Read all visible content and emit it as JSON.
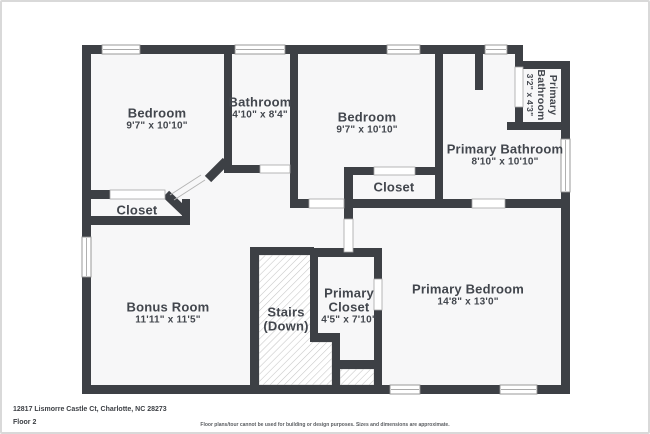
{
  "footer": {
    "address": "12817 Lismorre Castle Ct, Charlotte, NC 28273",
    "floor_label": "Floor 2",
    "disclaimer": "Floor plans/tour cannot be used for building or design purposes. Sizes and dimensions are approximate."
  },
  "colors": {
    "wall": "#3d4045",
    "floor": "#f7f7f8",
    "label": "#42464d",
    "window_stroke": "#8e8e8e",
    "door_stroke": "#a6a6a6",
    "hatch_line": "#c6c6c6",
    "hatch_border": "#c9c9c9",
    "frame_border": "#d9d9d9"
  },
  "floorplan": {
    "floor_outline": "84,47 517,47 517,63 564,63 564,388 84,388",
    "stairs": [
      "257,253 310,253 310,340 330,340 330,383 257,383",
      "338,367 372,367 372,383 338,383"
    ],
    "walls": [
      {
        "x": 80,
        "y": 43,
        "w": 441,
        "h": 9,
        "n": "wall-outer-top"
      },
      {
        "x": 80,
        "y": 43,
        "w": 9,
        "h": 349,
        "n": "wall-outer-left"
      },
      {
        "x": 80,
        "y": 383,
        "w": 488,
        "h": 9,
        "n": "wall-outer-bottom"
      },
      {
        "x": 559,
        "y": 59,
        "w": 9,
        "h": 333,
        "n": "wall-outer-right"
      },
      {
        "x": 513,
        "y": 59,
        "w": 55,
        "h": 8,
        "n": "wall-primary-bath-small-top"
      },
      {
        "x": 513,
        "y": 43,
        "w": 8,
        "h": 24,
        "n": "wall-primary-bath-small-left-upper"
      },
      {
        "x": 513,
        "y": 105,
        "w": 8,
        "h": 23,
        "n": "wall-primary-bath-small-left-lower"
      },
      {
        "x": 505,
        "y": 120,
        "w": 63,
        "h": 8,
        "n": "wall-primary-bath-small-bottom"
      },
      {
        "x": 222,
        "y": 43,
        "w": 8,
        "h": 120,
        "n": "wall-bedroom1-bathroom"
      },
      {
        "x": 288,
        "y": 43,
        "w": 8,
        "h": 162,
        "n": "wall-bathroom-bedroom2"
      },
      {
        "x": 222,
        "y": 163,
        "w": 36,
        "h": 8,
        "n": "wall-bathroom-bottom"
      },
      {
        "x": 80,
        "y": 188,
        "w": 28,
        "h": 9,
        "n": "wall-bedroom1-bottom"
      },
      {
        "x": 80,
        "y": 214,
        "w": 108,
        "h": 9,
        "n": "wall-closet1-bottom"
      },
      {
        "x": 180,
        "y": 197,
        "w": 8,
        "h": 26,
        "n": "wall-closet1-right"
      },
      {
        "x": 288,
        "y": 197,
        "w": 19,
        "h": 9,
        "n": "wall-bedroom2-bottom"
      },
      {
        "x": 342,
        "y": 197,
        "w": 128,
        "h": 9,
        "n": "wall-mid-horizontal-left"
      },
      {
        "x": 503,
        "y": 197,
        "w": 57,
        "h": 9,
        "n": "wall-mid-horizontal-right"
      },
      {
        "x": 342,
        "y": 165,
        "w": 9,
        "h": 52,
        "n": "wall-closet2-left"
      },
      {
        "x": 342,
        "y": 165,
        "w": 30,
        "h": 8,
        "n": "wall-closet2-top-left"
      },
      {
        "x": 413,
        "y": 165,
        "w": 28,
        "h": 8,
        "n": "wall-closet2-top-right"
      },
      {
        "x": 433,
        "y": 43,
        "w": 8,
        "h": 163,
        "n": "wall-bedroom2-right"
      },
      {
        "x": 473,
        "y": 52,
        "w": 8,
        "h": 36,
        "n": "wall-primary-bath-niche"
      },
      {
        "x": 248,
        "y": 245,
        "w": 9,
        "h": 147,
        "n": "wall-stairs-left"
      },
      {
        "x": 248,
        "y": 245,
        "w": 64,
        "h": 8,
        "n": "wall-stairs-top"
      },
      {
        "x": 308,
        "y": 246,
        "w": 72,
        "h": 9,
        "n": "wall-primary-closet-top"
      },
      {
        "x": 308,
        "y": 246,
        "w": 8,
        "h": 90,
        "n": "wall-primary-closet-left"
      },
      {
        "x": 308,
        "y": 331,
        "w": 30,
        "h": 9,
        "n": "wall-primary-closet-step-h"
      },
      {
        "x": 330,
        "y": 331,
        "w": 8,
        "h": 52,
        "n": "wall-primary-closet-step-v"
      },
      {
        "x": 330,
        "y": 358,
        "w": 48,
        "h": 9,
        "n": "wall-primary-closet-lower-h"
      },
      {
        "x": 372,
        "y": 246,
        "w": 8,
        "h": 31,
        "n": "wall-primary-closet-right-upper"
      },
      {
        "x": 372,
        "y": 308,
        "w": 8,
        "h": 84,
        "n": "wall-primary-closet-right-lower"
      }
    ],
    "diagonal_walls": [
      {
        "x1": 224,
        "y1": 159,
        "x2": 206,
        "y2": 177,
        "w": 9
      },
      {
        "x1": 164,
        "y1": 192,
        "x2": 185,
        "y2": 212,
        "w": 9
      }
    ],
    "door_arcs": [
      {
        "x1": 203,
        "y1": 178,
        "x2": 172,
        "y2": 198
      },
      {
        "x1": 199,
        "y1": 173,
        "x2": 168,
        "y2": 193
      }
    ],
    "doors": [
      {
        "x": 108,
        "y": 188,
        "w": 55,
        "h": 9
      },
      {
        "x": 258,
        "y": 163,
        "w": 30,
        "h": 8
      },
      {
        "x": 307,
        "y": 197,
        "w": 35,
        "h": 9
      },
      {
        "x": 372,
        "y": 165,
        "w": 41,
        "h": 8
      },
      {
        "x": 470,
        "y": 197,
        "w": 33,
        "h": 9
      },
      {
        "x": 513,
        "y": 65,
        "w": 8,
        "h": 40
      },
      {
        "x": 372,
        "y": 277,
        "w": 8,
        "h": 31
      },
      {
        "x": 342,
        "y": 217,
        "w": 9,
        "h": 33
      }
    ],
    "windows": [
      {
        "x": 100,
        "y": 43,
        "w": 38,
        "h": 9
      },
      {
        "x": 233,
        "y": 43,
        "w": 50,
        "h": 9
      },
      {
        "x": 385,
        "y": 43,
        "w": 33,
        "h": 9
      },
      {
        "x": 483,
        "y": 43,
        "w": 22,
        "h": 9
      },
      {
        "x": 80,
        "y": 235,
        "w": 9,
        "h": 40
      },
      {
        "x": 559,
        "y": 137,
        "w": 9,
        "h": 53
      },
      {
        "x": 388,
        "y": 383,
        "w": 30,
        "h": 9
      },
      {
        "x": 498,
        "y": 383,
        "w": 37,
        "h": 9
      }
    ],
    "rooms": [
      {
        "id": "bedroom-1",
        "lines": [
          "Bedroom"
        ],
        "dims": "9'7\" x 10'10\"",
        "cx": 155,
        "cy": 111
      },
      {
        "id": "bathroom",
        "lines": [
          "Bathroom"
        ],
        "dims": "4'10\" x 8'4\"",
        "cx": 258,
        "cy": 100
      },
      {
        "id": "bedroom-2",
        "lines": [
          "Bedroom"
        ],
        "dims": "9'7\" x 10'10\"",
        "cx": 365,
        "cy": 115
      },
      {
        "id": "primary-bathroom-small",
        "lines": [
          "Primary",
          "Bathroom"
        ],
        "dims": "3'2\" x 4'3\"",
        "cx": 551,
        "cy": 93,
        "rotate": 90,
        "small": true
      },
      {
        "id": "primary-bathroom",
        "lines": [
          "Primary Bathroom"
        ],
        "dims": "8'10\" x 10'10\"",
        "cx": 503,
        "cy": 147
      },
      {
        "id": "closet-1",
        "lines": [
          "Closet"
        ],
        "cx": 135,
        "cy": 208
      },
      {
        "id": "closet-2",
        "lines": [
          "Closet"
        ],
        "cx": 392,
        "cy": 185
      },
      {
        "id": "bonus-room",
        "lines": [
          "Bonus Room"
        ],
        "dims": "11'11\" x 11'5\"",
        "cx": 166,
        "cy": 305
      },
      {
        "id": "stairs",
        "lines": [
          "Stairs",
          "(Down)"
        ],
        "cx": 284,
        "cy": 310
      },
      {
        "id": "primary-closet",
        "lines": [
          "Primary",
          "Closet"
        ],
        "dims": "4'5\" x 7'10\"",
        "cx": 347,
        "cy": 291
      },
      {
        "id": "primary-bedroom",
        "lines": [
          "Primary Bedroom"
        ],
        "dims": "14'8\" x 13'0\"",
        "cx": 466,
        "cy": 287
      }
    ]
  }
}
